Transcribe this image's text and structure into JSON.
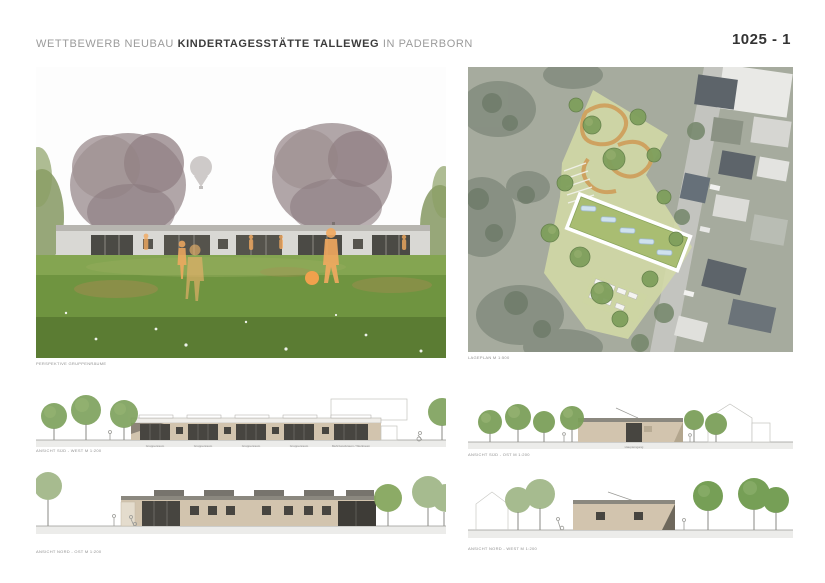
{
  "header": {
    "title_prefix": "WETTBEWERB NEUBAU ",
    "title_bold": "KINDERTAGESSTÄTTE TALLEWEG",
    "title_suffix": " IN PADERBORN",
    "panel_number": "1025 - 1"
  },
  "perspective": {
    "caption": "PERSPEKTIVE GRUPPENRÄUME"
  },
  "siteplan": {
    "caption": "LAGEPLAN M 1:500"
  },
  "elevations": {
    "sued_west": {
      "caption": "ANSICHT SÜD - WEST M 1:200",
      "room_labels": [
        "Gruppenraum",
        "Gruppenraum",
        "Gruppenraum",
        "Gruppenraum",
        "Mehrzweckraum / Werkraum"
      ]
    },
    "nord_ost": {
      "caption": "ANSICHT NORD - OST M 1:200"
    },
    "sued_ost": {
      "caption": "ANSICHT SÜD - OST M 1:200",
      "entrance_label": "Haupteingang"
    },
    "nord_west": {
      "caption": "ANSICHT NORD - WEST M 1:200"
    }
  },
  "colors": {
    "accent_orange": "#f2a95f",
    "facade_beige": "#d2c4ae",
    "glass_dark": "#45433d",
    "tree_green": "#7ca05a",
    "site_green": "#d3dba6",
    "aerial_base": "#a6ab9e",
    "title_gray": "#9b9b9b",
    "title_dark": "#3c3c3c"
  }
}
